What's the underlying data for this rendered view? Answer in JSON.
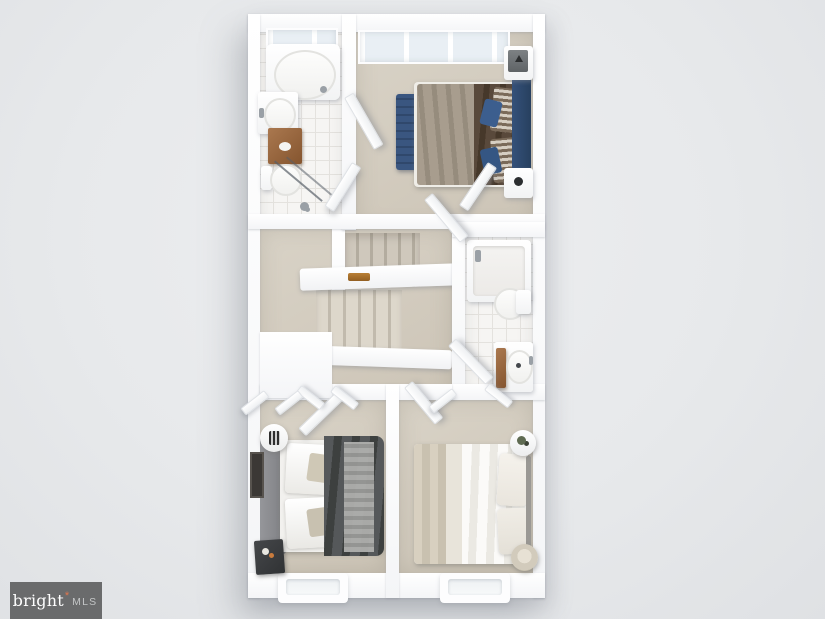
{
  "watermark": {
    "brand": "bright",
    "mark": "*",
    "suffix": "MLS",
    "bg_color": "#6a6b6c",
    "brand_color": "#fefefe",
    "mark_color": "#e2764d",
    "suffix_color": "#c3c5c6"
  },
  "render": {
    "type": "3d-floorplan-top-down",
    "background_color": "#e7e9eb",
    "wall_color": "#fbfcfd",
    "carpet_color": "#d2cabd",
    "tile_color": "#f6f5f3",
    "accent_colors": {
      "navy_headboard": "#2e4867",
      "blue_bench": "#3a5680",
      "brown_duvet": "#4c3f31",
      "charcoal_duvet": "#434645",
      "wood_cabinet": "#9a6a42"
    },
    "rooms": [
      {
        "id": "ensuite-bathroom",
        "position": "top-left",
        "fixtures": [
          "soaking-tub",
          "vanity-sink",
          "wood-cabinet",
          "toilet",
          "glass-shower"
        ]
      },
      {
        "id": "master-bedroom",
        "position": "top-right",
        "fixtures": [
          "double-bed",
          "blue-bench",
          "nightstand-top",
          "nightstand-bottom",
          "dresser"
        ]
      },
      {
        "id": "hallway-landing",
        "position": "middle",
        "fixtures": [
          "staircase-upper-flight",
          "staircase-lower-flight",
          "railing",
          "wood-handrail"
        ]
      },
      {
        "id": "hall-bathroom",
        "position": "middle-right",
        "fixtures": [
          "bathtub",
          "toilet",
          "vanity-sink"
        ]
      },
      {
        "id": "bedroom-two",
        "position": "bottom-left",
        "fixtures": [
          "double-bed",
          "round-side-table",
          "dark-nightstand",
          "wall-picture",
          "closet-bifold-doors"
        ]
      },
      {
        "id": "bedroom-three",
        "position": "bottom-right",
        "fixtures": [
          "double-bed",
          "round-side-table",
          "plant",
          "basket",
          "closet-bifold-doors"
        ]
      }
    ],
    "windows": [
      "master-bedroom-top-bay",
      "ensuite-top-window",
      "bedroom-two-bottom-window",
      "bedroom-three-bottom-window"
    ]
  }
}
